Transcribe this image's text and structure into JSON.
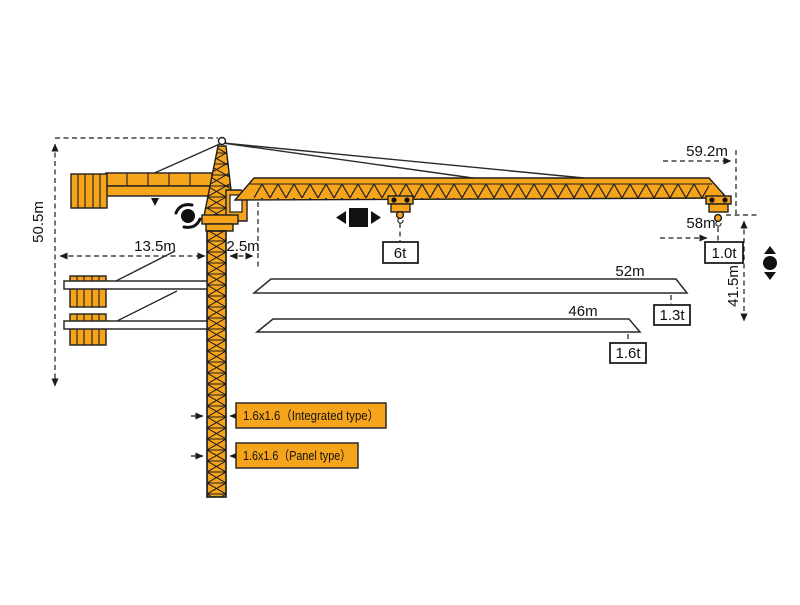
{
  "colors": {
    "crane_orange": "#F6A41C",
    "outline_black": "#1E1E1E",
    "dimension_black": "#1A1A1A",
    "white_part": "#FFFFFF"
  },
  "dimensions": {
    "overall_height": "50.5m",
    "counter_jib_length": "13.5m",
    "min_trolley_radius": "2.5m",
    "jib_tip_radius": "59.2m",
    "max_hook_radius": "58m",
    "tip_hook_height": "41.5m"
  },
  "loads": {
    "max_capacity": "6t",
    "tip_load_59m": "1.0t",
    "tip_load_52m": "1.3t",
    "tip_load_46m": "1.6t"
  },
  "jib_variants": {
    "variant_52": "52m",
    "variant_46": "46m"
  },
  "mast_sections": {
    "integrated": "1.6x1.6（Integrated type）",
    "panel": "1.6x1.6（Panel type）"
  },
  "icons": {
    "slew": "slew-rotation-icon",
    "trolley": "trolley-travel-icon",
    "hoist": "hoist-up-down-icon"
  }
}
